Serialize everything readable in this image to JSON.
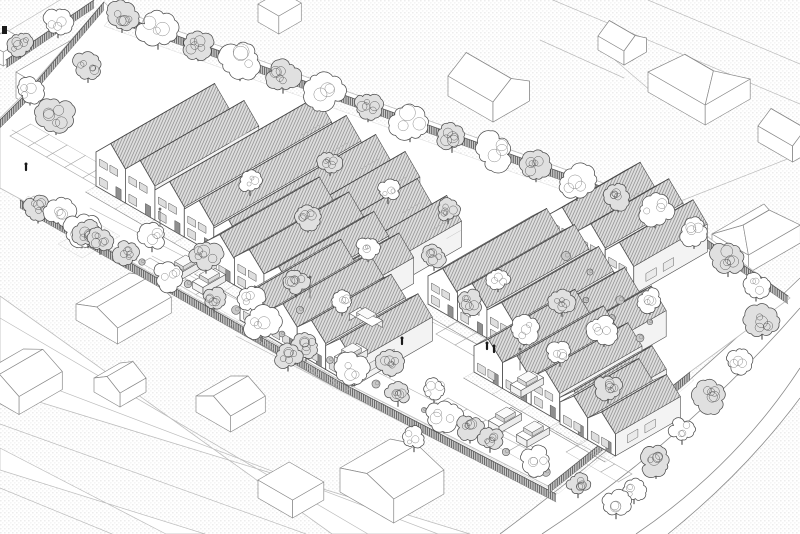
{
  "meta": {
    "kind": "axonometric-architectural-site-plan",
    "style": "monochrome line drawing, stippled ground, hatched roofs",
    "canvas": {
      "width": 800,
      "height": 534
    }
  },
  "palette": {
    "paper": "#ffffff",
    "line_dark": "#4f4f4f",
    "line_mid": "#8a8a8a",
    "line_light": "#bdbdbd",
    "stipple_dot": "#c4c4c4",
    "roof_light": "#ebebeb",
    "roof_dark": "#dfdfdf",
    "roof_hatch_light": "#9f9f9f",
    "roof_hatch_dark": "#868686",
    "fence_fill": "#cdcdcd",
    "fence_line": "#3d3d3d",
    "facade": "#ffffff",
    "side_wall": "#f3f3f3",
    "glass": "#dedede",
    "door": "#8f8f8f",
    "figure": "#1a1a1a"
  },
  "scene": {
    "site_polygon": [
      [
        108,
        6
      ],
      [
        665,
        205
      ],
      [
        790,
        298
      ],
      [
        690,
        372
      ],
      [
        548,
        486
      ],
      [
        336,
        378
      ],
      [
        22,
        200
      ],
      [
        0,
        188
      ],
      [
        0,
        118
      ],
      [
        26,
        92
      ],
      [
        104,
        2
      ]
    ],
    "garden_bands": [
      [
        [
          112,
          16
        ],
        [
          660,
          212
        ],
        [
          652,
          222
        ],
        [
          104,
          26
        ]
      ],
      [
        [
          28,
          196
        ],
        [
          336,
          378
        ],
        [
          330,
          386
        ],
        [
          22,
          204
        ]
      ],
      [
        [
          336,
          378
        ],
        [
          552,
          490
        ],
        [
          546,
          496
        ],
        [
          330,
          386
        ]
      ],
      [
        [
          552,
          488
        ],
        [
          688,
          374
        ],
        [
          694,
          380
        ],
        [
          558,
          494
        ]
      ],
      [
        [
          58,
          244
        ],
        [
          96,
          222
        ],
        [
          120,
          236
        ],
        [
          82,
          258
        ]
      ]
    ],
    "roads": {
      "bottom_left_band": [
        [
          0,
          296
        ],
        [
          0,
          390
        ],
        [
          470,
          534
        ],
        [
          332,
          534
        ]
      ],
      "bottom_left_lines": [
        [
          0,
          318,
          368,
          534
        ],
        [
          0,
          368,
          438,
          534
        ]
      ],
      "lane_band": [
        [
          0,
          448
        ],
        [
          0,
          470
        ],
        [
          205,
          534
        ],
        [
          166,
          534
        ]
      ],
      "curved_fill": "M500,534 Q655,418 800,278 L800,398 Q745,472 668,534 Z",
      "curved_strokes": [
        "M500,534 Q655,418 800,278",
        "M542,534 Q685,440 800,308",
        "M636,534 Q736,466 800,368",
        "M668,534 Q745,472 800,398"
      ]
    },
    "parcel_lines": [
      [
        553,
        0,
        800,
        104
      ],
      [
        648,
        0,
        800,
        64
      ],
      [
        540,
        40,
        624,
        78
      ],
      [
        668,
        206,
        800,
        154
      ],
      [
        0,
        424,
        306,
        534
      ],
      [
        0,
        488,
        112,
        534
      ],
      [
        615,
        60,
        652,
        92
      ],
      [
        60,
        0,
        0,
        36
      ]
    ],
    "street_lines": [
      [
        90,
        208,
        320,
        327
      ],
      [
        152,
        256,
        548,
        460
      ],
      [
        236,
        336,
        418,
        430
      ],
      [
        420,
        316,
        610,
        410
      ],
      [
        12,
        130,
        186,
        230
      ]
    ],
    "context_buildings": [
      {
        "p": [
          258,
          22
        ],
        "da": 26,
        "db": 24,
        "h": 18,
        "roof": "flat"
      },
      {
        "p": [
          -14,
          56
        ],
        "da": 24,
        "db": 20,
        "h": 14,
        "roof": "flat"
      },
      {
        "p": [
          598,
          50
        ],
        "da": 26,
        "db": 30,
        "h": 14,
        "roof": "gableB",
        "rh": 9
      },
      {
        "p": [
          98,
          70
        ],
        "da": 26,
        "db": 22,
        "h": 16,
        "roof": "flat"
      },
      {
        "p": [
          648,
          92
        ],
        "da": 52,
        "db": 66,
        "h": 20,
        "roof": "hipB",
        "rh": 13
      },
      {
        "p": [
          448,
          96
        ],
        "da": 42,
        "db": 52,
        "h": 20,
        "roof": "gableB",
        "rh": 13
      },
      {
        "p": [
          16,
          98
        ],
        "da": 100,
        "db": 52,
        "h": 26,
        "roof": "flat"
      },
      {
        "p": [
          758,
          142
        ],
        "da": 30,
        "db": 40,
        "h": 16,
        "roof": "gableB",
        "rh": 10
      },
      {
        "p": [
          712,
          252
        ],
        "da": 60,
        "db": 42,
        "h": 18,
        "roof": "hipA",
        "rh": 12
      },
      {
        "p": [
          76,
          320
        ],
        "da": 62,
        "db": 48,
        "h": 16,
        "roof": "gableA",
        "rh": 9
      },
      {
        "p": [
          94,
          392
        ],
        "da": 30,
        "db": 30,
        "h": 14,
        "roof": "gableA",
        "rh": 9
      },
      {
        "p": [
          -20,
          392
        ],
        "da": 50,
        "db": 45,
        "h": 18,
        "roof": "gableA",
        "rh": 11
      },
      {
        "p": [
          196,
          412
        ],
        "da": 40,
        "db": 40,
        "h": 16,
        "roof": "gableA",
        "rh": 10
      },
      {
        "p": [
          340,
          492
        ],
        "da": 58,
        "db": 62,
        "h": 24,
        "roof": "gableA",
        "rh": 10
      },
      {
        "p": [
          258,
          498
        ],
        "da": 36,
        "db": 40,
        "h": 18,
        "roof": "flat"
      }
    ],
    "house_rows": [
      {
        "anchor": [
          96,
          186
        ],
        "uw": 34,
        "rh": 17,
        "tails": true,
        "units": [
          {
            "len": 120,
            "wh": 34
          },
          {
            "len": 120,
            "wh": 34
          },
          {
            "len": 170,
            "wh": 30
          },
          {
            "len": 170,
            "wh": 28
          },
          {
            "len": 170,
            "wh": 26
          },
          {
            "len": 170,
            "wh": 26
          },
          {
            "len": 150,
            "wh": 26
          },
          {
            "len": 150,
            "wh": 26
          }
        ]
      },
      {
        "anchor": [
          548,
          245
        ],
        "uw": 33,
        "rh": 16,
        "tails": true,
        "units": [
          {
            "len": 90,
            "wh": 30
          },
          {
            "len": 90,
            "wh": 30
          },
          {
            "len": 85,
            "wh": 28
          }
        ]
      },
      {
        "anchor": [
          205,
          268
        ],
        "uw": 34,
        "rh": 16,
        "units": [
          {
            "len": 115,
            "wh": 26
          },
          {
            "len": 115,
            "wh": 28
          },
          {
            "len": 110,
            "wh": 28
          },
          {
            "len": 105,
            "wh": 26
          }
        ]
      },
      {
        "anchor": [
          428,
          304
        ],
        "uw": 34,
        "rh": 16,
        "units": [
          {
            "len": 120,
            "wh": 28
          },
          {
            "len": 118,
            "wh": 30
          },
          {
            "len": 112,
            "wh": 28
          },
          {
            "len": 108,
            "wh": 26
          },
          {
            "len": 105,
            "wh": 26
          }
        ]
      },
      {
        "anchor": [
          240,
          320
        ],
        "uw": 33,
        "rh": 15,
        "units": [
          {
            "len": 100,
            "wh": 24
          },
          {
            "len": 100,
            "wh": 26
          },
          {
            "len": 92,
            "wh": 26
          },
          {
            "len": 90,
            "wh": 24
          }
        ]
      },
      {
        "anchor": [
          474,
          372
        ],
        "uw": 33,
        "rh": 15,
        "units": [
          {
            "len": 100,
            "wh": 26
          },
          {
            "len": 100,
            "wh": 26
          },
          {
            "len": 95,
            "wh": 28
          },
          {
            "len": 90,
            "wh": 24
          }
        ]
      },
      {
        "anchor": [
          560,
          424
        ],
        "uw": 32,
        "rh": 14,
        "units": [
          {
            "len": 75,
            "wh": 22
          },
          {
            "len": 75,
            "wh": 22
          }
        ]
      }
    ],
    "fences": [
      [
        110,
        12,
        662,
        208
      ],
      [
        104,
        2,
        26,
        94
      ],
      [
        26,
        94,
        0,
        120
      ],
      [
        94,
        0,
        6,
        60
      ],
      [
        20,
        200,
        340,
        382
      ],
      [
        340,
        382,
        556,
        494
      ],
      [
        664,
        210,
        788,
        296
      ],
      [
        548,
        486,
        690,
        372
      ]
    ],
    "parking_strips": [
      {
        "start": [
          10,
          136
        ],
        "n": 9,
        "step": 21,
        "dlen": 24,
        "dir": 1
      },
      {
        "start": [
          34,
          196
        ],
        "n": 5,
        "step": 21,
        "dlen": 12,
        "dir": -1
      },
      {
        "start": [
          436,
          334
        ],
        "n": 6,
        "step": 22,
        "dlen": 24,
        "dir": 1
      },
      {
        "start": [
          448,
          398
        ],
        "n": 6,
        "step": 22,
        "dlen": 20,
        "dir": -1
      },
      {
        "start": [
          580,
          444
        ],
        "n": 4,
        "step": 20,
        "dlen": 16,
        "dir": -1
      },
      {
        "start": [
          150,
          258
        ],
        "n": 5,
        "step": 21,
        "dlen": 10,
        "dir": -1
      }
    ],
    "cars": [
      {
        "c": [
          184,
          272
        ],
        "dir": "a"
      },
      {
        "c": [
          209,
          285
        ],
        "dir": "a"
      },
      {
        "c": [
          366,
          324
        ],
        "dir": "b"
      },
      {
        "c": [
          351,
          360
        ],
        "dir": "a"
      },
      {
        "c": [
          527,
          388
        ],
        "dir": "a"
      },
      {
        "c": [
          505,
          424
        ],
        "dir": "a"
      },
      {
        "c": [
          533,
          438
        ],
        "dir": "a"
      }
    ],
    "people": [
      [
        26,
        170
      ],
      [
        487,
        349
      ],
      [
        494,
        352
      ],
      [
        402,
        344
      ]
    ],
    "lampposts": [
      [
        310,
        298
      ],
      [
        520,
        370
      ],
      [
        160,
        230
      ]
    ],
    "sign_marks": [
      [
        2,
        26,
        5,
        8
      ]
    ],
    "shrubs": [
      [
        142,
        262
      ],
      [
        188,
        284
      ],
      [
        236,
        310
      ],
      [
        282,
        334
      ],
      [
        330,
        360
      ],
      [
        376,
        384
      ],
      [
        424,
        410
      ],
      [
        462,
        432
      ],
      [
        506,
        452
      ],
      [
        546,
        472
      ],
      [
        586,
        300
      ],
      [
        612,
        318
      ],
      [
        640,
        338
      ],
      [
        566,
        256
      ],
      [
        590,
        272
      ],
      [
        300,
        310
      ],
      [
        620,
        300
      ],
      [
        650,
        322
      ]
    ],
    "trees": [
      [
        122,
        16,
        15,
        1
      ],
      [
        158,
        30,
        19,
        0
      ],
      [
        198,
        45,
        14,
        1
      ],
      [
        240,
        60,
        21,
        0
      ],
      [
        283,
        76,
        16,
        1
      ],
      [
        324,
        90,
        20,
        0
      ],
      [
        368,
        106,
        14,
        1
      ],
      [
        410,
        121,
        21,
        0
      ],
      [
        452,
        136,
        15,
        1
      ],
      [
        494,
        151,
        19,
        0
      ],
      [
        536,
        166,
        14,
        1
      ],
      [
        577,
        182,
        18,
        0
      ],
      [
        618,
        197,
        13,
        1
      ],
      [
        655,
        210,
        17,
        0
      ],
      [
        38,
        208,
        13,
        1
      ],
      [
        82,
        230,
        17,
        0
      ],
      [
        126,
        253,
        12,
        1
      ],
      [
        170,
        276,
        15,
        0
      ],
      [
        214,
        299,
        11,
        1
      ],
      [
        262,
        323,
        18,
        0
      ],
      [
        306,
        346,
        13,
        1
      ],
      [
        352,
        369,
        16,
        0
      ],
      [
        398,
        392,
        12,
        1
      ],
      [
        444,
        415,
        17,
        0
      ],
      [
        490,
        438,
        12,
        1
      ],
      [
        536,
        461,
        15,
        0
      ],
      [
        578,
        484,
        11,
        1
      ],
      [
        616,
        503,
        14,
        0
      ],
      [
        694,
        232,
        15,
        0
      ],
      [
        728,
        258,
        18,
        1
      ],
      [
        756,
        286,
        13,
        0
      ],
      [
        762,
        322,
        16,
        1
      ],
      [
        738,
        360,
        13,
        0
      ],
      [
        710,
        396,
        17,
        1
      ],
      [
        682,
        430,
        12,
        0
      ],
      [
        656,
        462,
        15,
        1
      ],
      [
        634,
        490,
        11,
        0
      ],
      [
        56,
        116,
        18,
        1
      ],
      [
        30,
        90,
        13,
        0
      ],
      [
        88,
        66,
        15,
        1
      ],
      [
        20,
        44,
        12,
        1
      ],
      [
        58,
        22,
        14,
        0
      ],
      [
        60,
        212,
        15,
        0
      ],
      [
        100,
        240,
        12,
        1
      ],
      [
        88,
        232,
        14,
        1
      ],
      [
        152,
        236,
        14,
        0
      ],
      [
        206,
        256,
        16,
        1
      ],
      [
        252,
        300,
        12,
        0
      ],
      [
        296,
        282,
        13,
        1
      ],
      [
        342,
        302,
        11,
        0
      ],
      [
        288,
        356,
        13,
        1
      ],
      [
        250,
        182,
        11,
        0
      ],
      [
        308,
        218,
        12,
        1
      ],
      [
        368,
        248,
        11,
        0
      ],
      [
        434,
        256,
        12,
        1
      ],
      [
        498,
        278,
        11,
        0
      ],
      [
        470,
        302,
        13,
        1
      ],
      [
        524,
        330,
        14,
        0
      ],
      [
        562,
        302,
        12,
        1
      ],
      [
        604,
        330,
        15,
        0
      ],
      [
        390,
        362,
        13,
        1
      ],
      [
        434,
        390,
        12,
        0
      ],
      [
        470,
        428,
        13,
        1
      ],
      [
        414,
        438,
        11,
        0
      ],
      [
        330,
        162,
        11,
        1
      ],
      [
        388,
        190,
        11,
        0
      ],
      [
        448,
        210,
        11,
        1
      ],
      [
        560,
        352,
        12,
        0
      ],
      [
        608,
        388,
        13,
        1
      ],
      [
        650,
        300,
        12,
        0
      ]
    ]
  }
}
